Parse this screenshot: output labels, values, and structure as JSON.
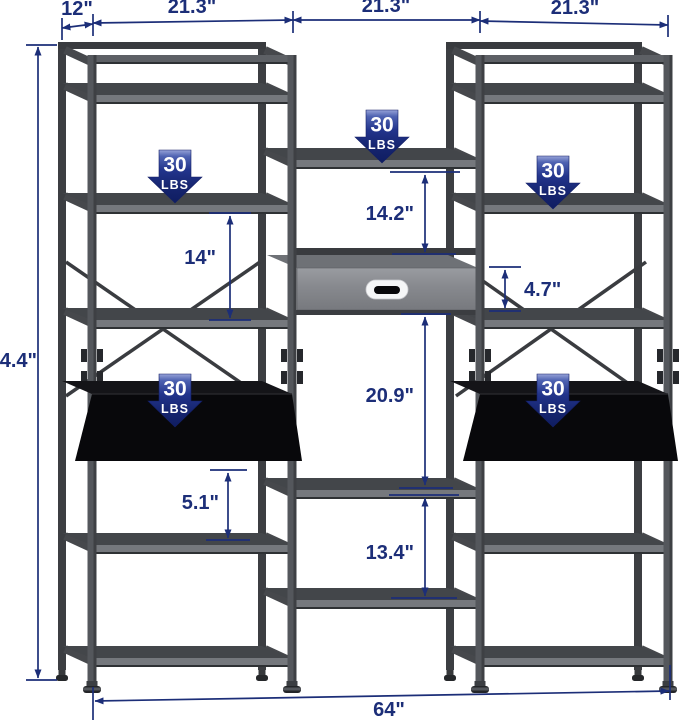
{
  "dimensions": {
    "depth": "12\"",
    "left_section_width": "21.3\"",
    "middle_section_width": "21.3\"",
    "right_section_width": "21.3\"",
    "total_height": "74.4\"",
    "left_shelf_spacing": "14\"",
    "shelf_to_drawer": "14.2\"",
    "drawer_height": "4.7\"",
    "drawer_to_shelf": "20.9\"",
    "desk_to_shelf": "5.1\"",
    "lower_shelf_spacing": "13.4\"",
    "total_width": "64\""
  },
  "load_badges": [
    {
      "value": "30",
      "unit": "LBS"
    },
    {
      "value": "30",
      "unit": "LBS"
    },
    {
      "value": "30",
      "unit": "LBS"
    },
    {
      "value": "30",
      "unit": "LBS"
    },
    {
      "value": "30",
      "unit": "LBS"
    }
  ],
  "colors": {
    "dimension_annotation": "#1c2e78",
    "badge_navy": "#22348c",
    "frame_gray": "#54575c",
    "shelf_edge_gray": "#75787d",
    "desk_black": "#08080b",
    "drawer_gray": "#87898e",
    "handle_white": "#f5f6f7"
  }
}
